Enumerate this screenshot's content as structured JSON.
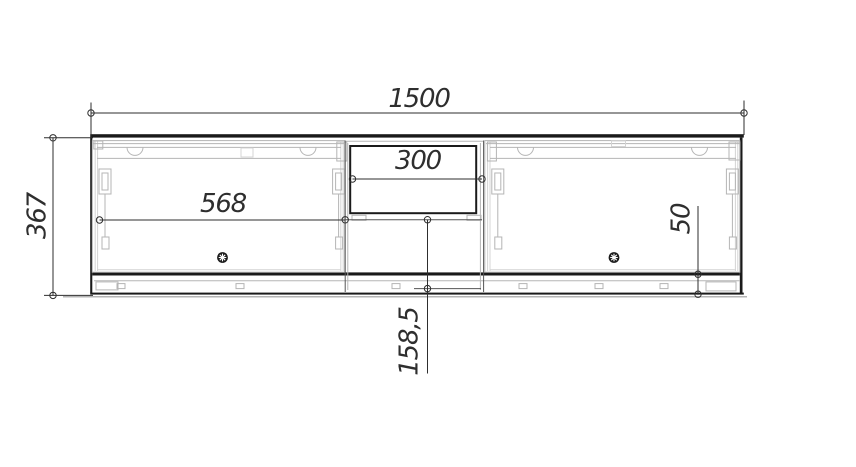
{
  "dims": {
    "total_width": "1500",
    "total_height": "367",
    "left_door_width": "568",
    "niche_width": "300",
    "shelf_to_bottom": "158,5",
    "bottom_offset": "50"
  },
  "colors": {
    "background": "#ffffff",
    "line": "#1a1a1a",
    "mid": "#555555",
    "detail": "#b5b5b5",
    "detail2": "#d4d4d4",
    "dim": "#2e2e2e",
    "shadow": "#9c9c9c"
  }
}
